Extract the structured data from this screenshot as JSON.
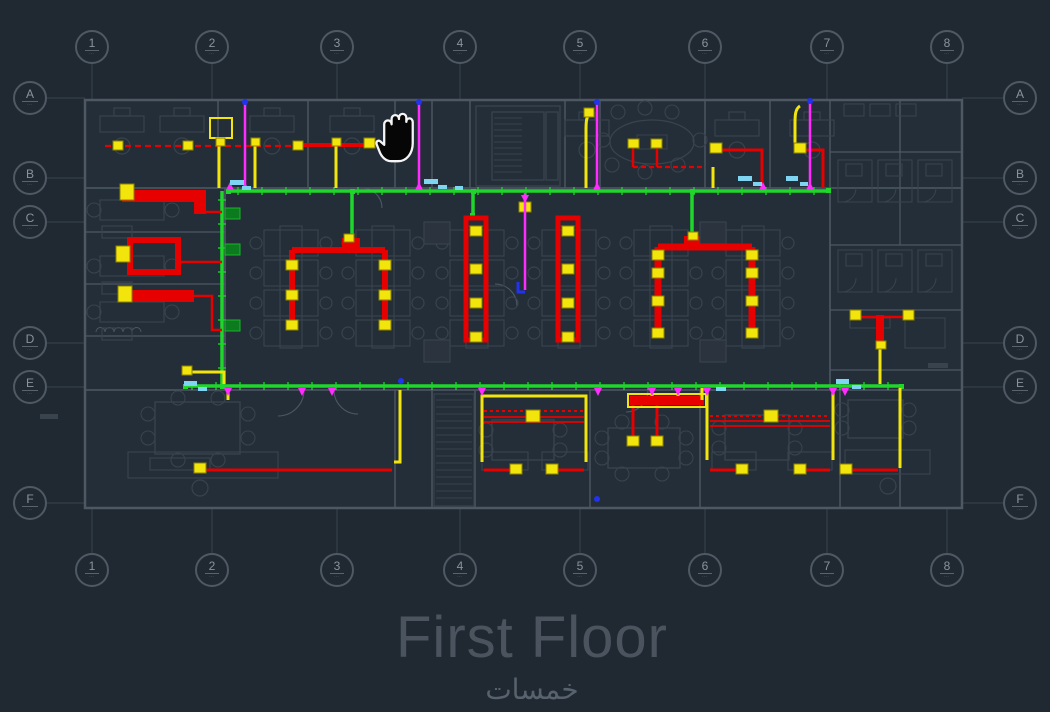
{
  "viewport": {
    "cursor": "hand-pan-cursor",
    "background": "#202932"
  },
  "drawing": {
    "title": "First Floor",
    "watermark": "خمسات",
    "grid": {
      "columns": [
        "1",
        "2",
        "3",
        "4",
        "5",
        "6",
        "7",
        "8"
      ],
      "rows": [
        "A",
        "B",
        "C",
        "D",
        "E",
        "F"
      ],
      "bubble_sub": "⋯"
    },
    "colors": {
      "walls": "#4d5863",
      "furniture": "#39434d",
      "cable_tray_green": "#1fd62b",
      "power_red": "#e60000",
      "conduit_yellow": "#f2e50c",
      "riser_magenta": "#ff2bff",
      "label_cyan": "#7fd4f2",
      "node_blue": "#2233ee",
      "panel_dark_green": "#0c7a1e",
      "title_gray": "#4b545e"
    }
  }
}
